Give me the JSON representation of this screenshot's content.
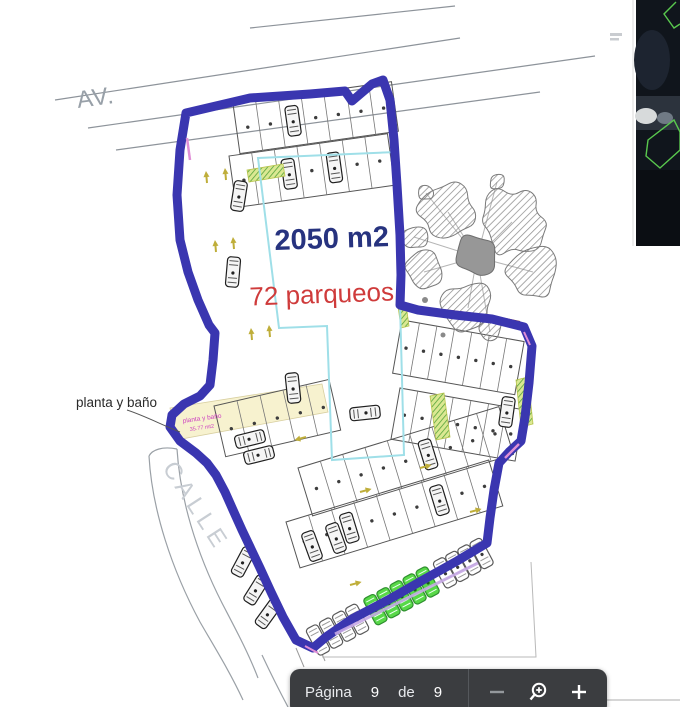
{
  "plan": {
    "avenue_label": "AV.",
    "street_label": "CALLE",
    "area_text": "2050 m2",
    "parqueos_text": "72 parqueos",
    "planta_banio_label": "planta y baño",
    "planta_banio_note_line1": "planta y baño",
    "planta_banio_note_line2": "35.77 mt2"
  },
  "toolbar": {
    "page_word": "Página",
    "current_page": "9",
    "of_word": "de",
    "total_pages": "9"
  },
  "icons": {
    "zoom_out": "zoom-out-minus-icon",
    "magnifier": "zoom-magnifier-plus-icon",
    "zoom_in": "zoom-in-plus-icon",
    "satellite": "satellite-thumbnail"
  },
  "colors": {
    "boundary_blue": "#3a36b0",
    "area_text_blue": "#27337f",
    "parqueos_red": "#cf3b3b",
    "highlight_green": "#58d848",
    "cyan_outline": "#9fdfe8",
    "toolbar_bg": "#3b3d40"
  }
}
